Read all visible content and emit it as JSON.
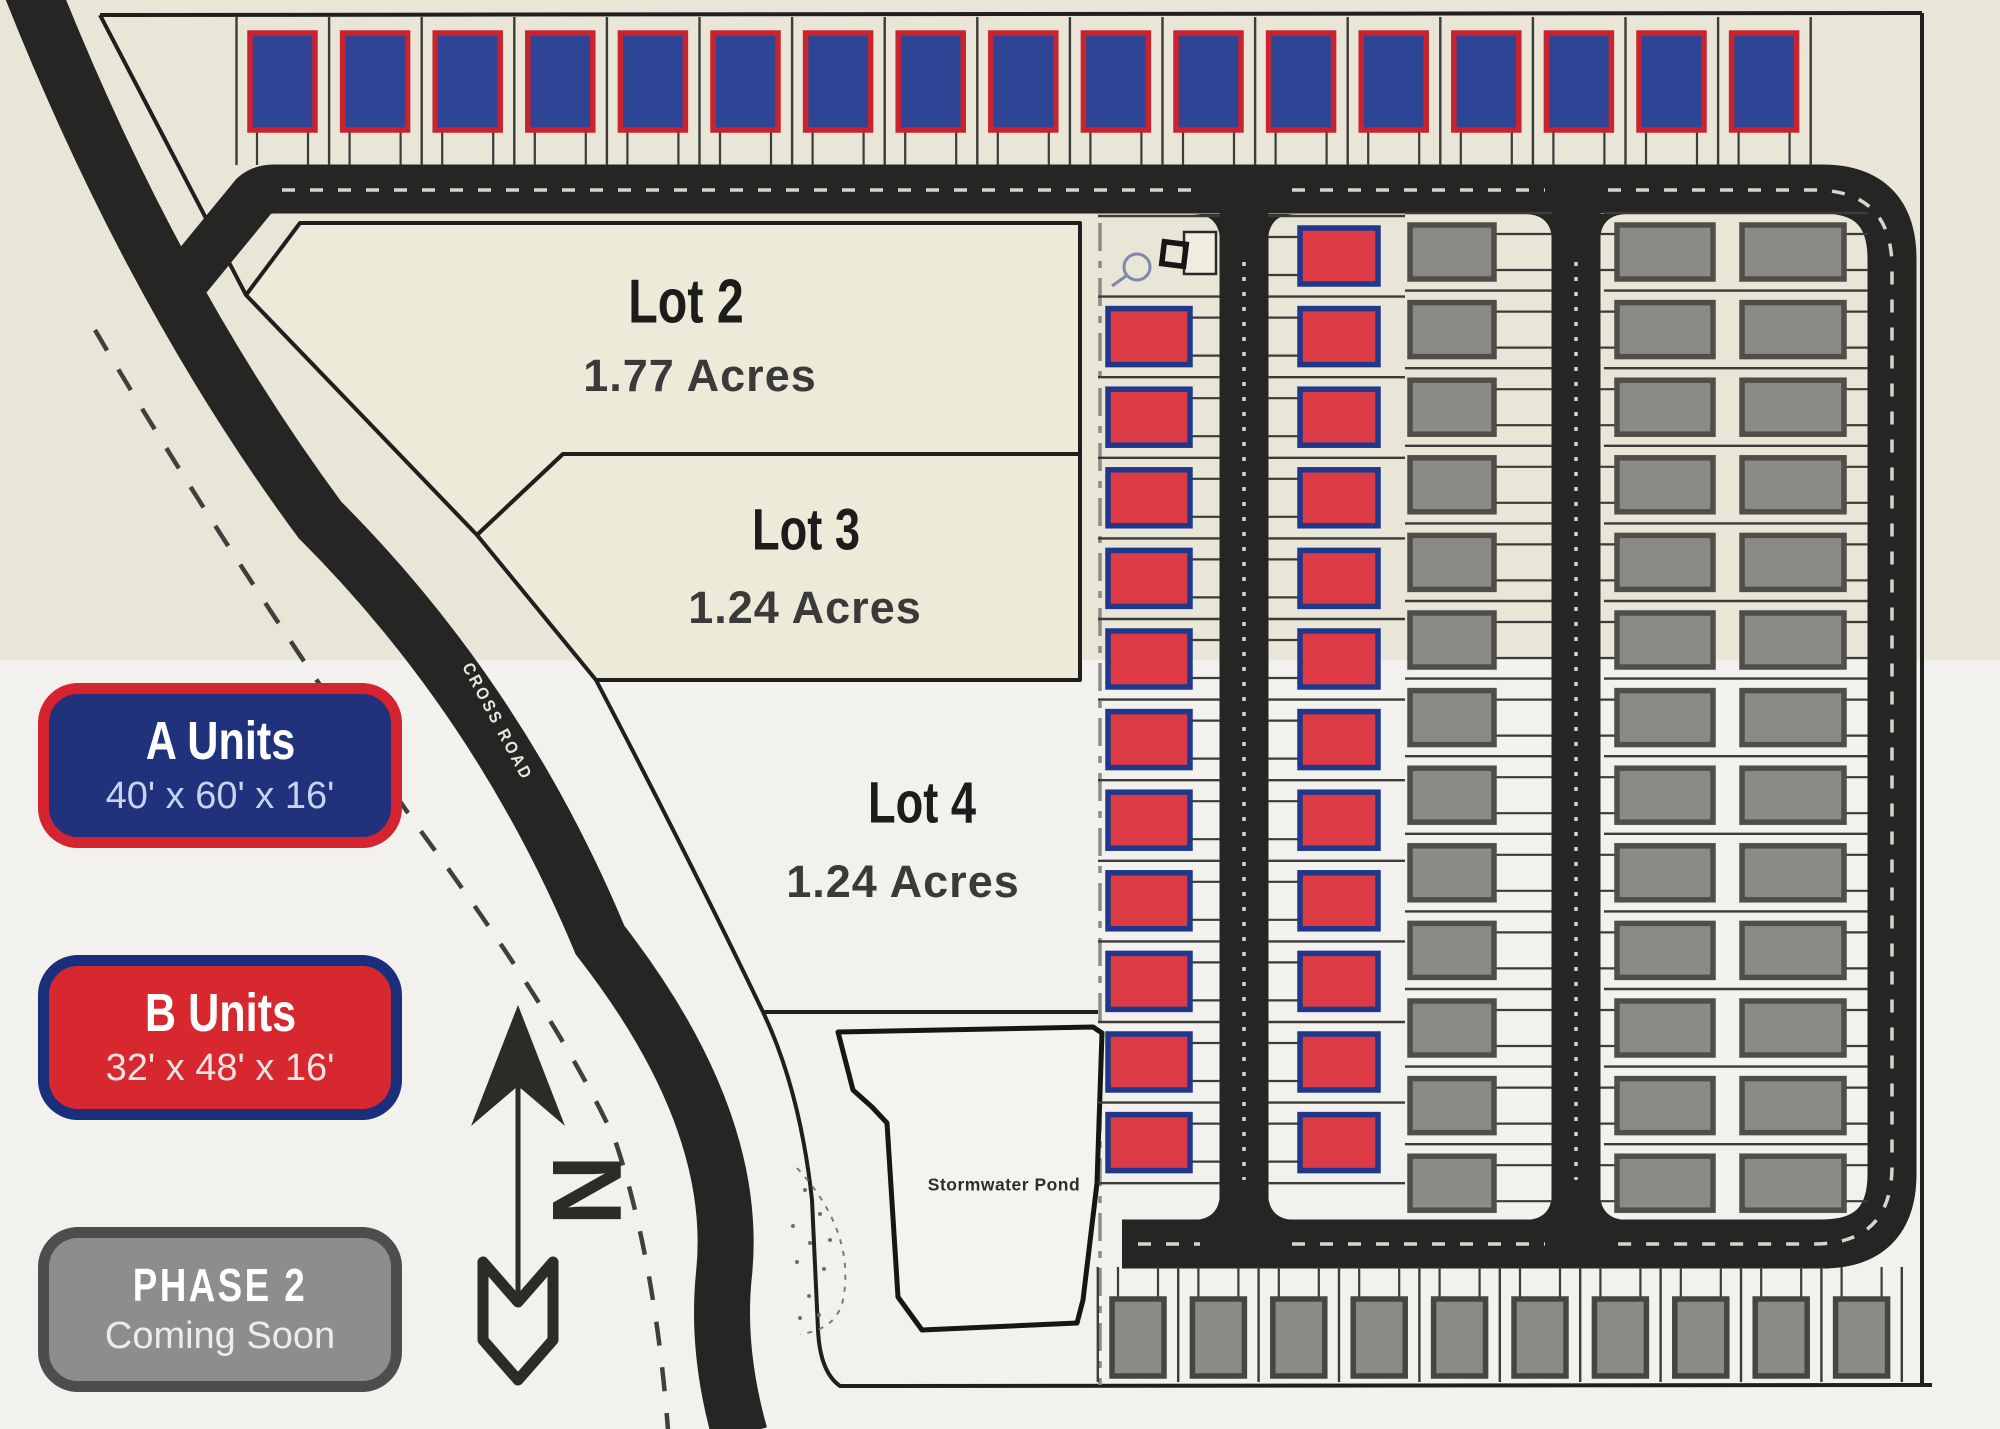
{
  "legend": {
    "a": {
      "title": "A Units",
      "dims": "40' x 60' x 16'",
      "bg": "#20327b",
      "border": "#d5242f",
      "dims_color": "#c7d3f0"
    },
    "b": {
      "title": "B Units",
      "dims": "32' x 48' x 16'",
      "bg": "#d8282f",
      "border": "#1b2e7c",
      "dims_color": "#f3e2e3"
    },
    "phase2": {
      "title": "PHASE 2",
      "subtitle": "Coming Soon",
      "bg": "#8d8d8d",
      "border": "#4d4d4d",
      "subtitle_color": "#ececec"
    }
  },
  "lots": [
    {
      "name": "Lot 2",
      "acres": "1.77 Acres"
    },
    {
      "name": "Lot 3",
      "acres": "1.24 Acres"
    },
    {
      "name": "Lot 4",
      "acres": "1.24 Acres"
    }
  ],
  "labels": {
    "road": "CROSS ROAD",
    "pond": "Stormwater Pond",
    "north": "N"
  },
  "units": {
    "top_row": {
      "type": "A Unit",
      "count": 17
    },
    "col1": {
      "type": "B Unit",
      "count": 11
    },
    "col2": {
      "type": "B Unit",
      "count": 12
    },
    "gray_col1": {
      "type": "Phase 2",
      "count": 13
    },
    "gray_col2": {
      "type": "Phase 2",
      "count": 13
    },
    "gray_col3": {
      "type": "Phase 2",
      "count": 13
    },
    "bottom_row": {
      "type": "Phase 2",
      "count": 10
    }
  },
  "colors": {
    "beige": "#e9e6d8",
    "light": "#f2f1ee",
    "lot_fill": "#edeada",
    "road": "#252523",
    "a_fill": "#2e4494",
    "a_border": "#c8232e",
    "b_fill": "#dc3a45",
    "b_border": "#20388c",
    "gray_fill": "#8b8a85",
    "gray_border": "#4f4e49",
    "stall_line": "#3b3b38",
    "boundary": "#1f1f1d",
    "center_dash": "#d6d5d0"
  }
}
